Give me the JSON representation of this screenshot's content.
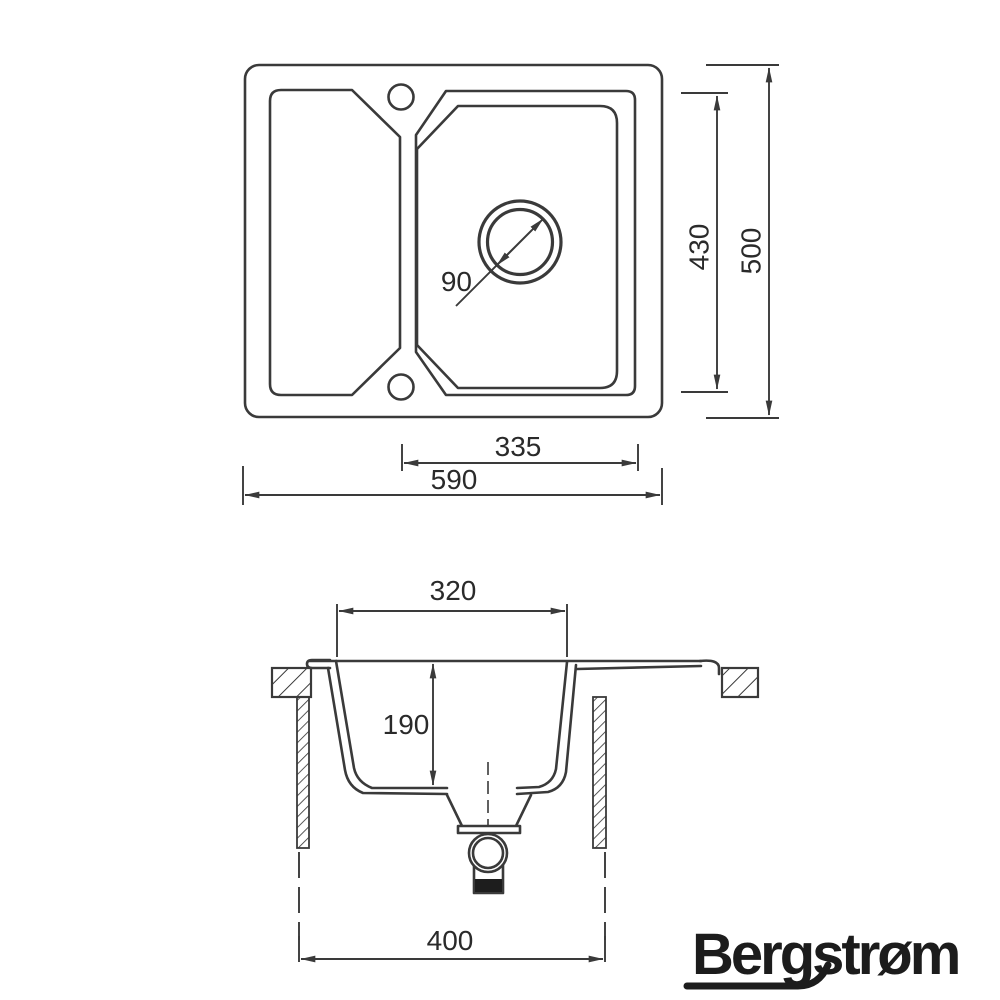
{
  "drawing": {
    "title": "Kitchen sink technical dimension drawing",
    "background": "#ffffff",
    "line_color": "#3a3a3a",
    "text_color": "#2a2a2a"
  },
  "top_view": {
    "dim_drain_diameter": "90",
    "dim_bowl_length": "430",
    "dim_overall_depth": "500",
    "dim_bowl_width": "335",
    "dim_overall_width": "590"
  },
  "section_view": {
    "dim_bowl_opening": "320",
    "dim_bowl_depth": "190",
    "dim_cabinet_width": "400"
  },
  "brand": {
    "wordmark": "Bergstrøm",
    "color": "#1c1c1c"
  }
}
